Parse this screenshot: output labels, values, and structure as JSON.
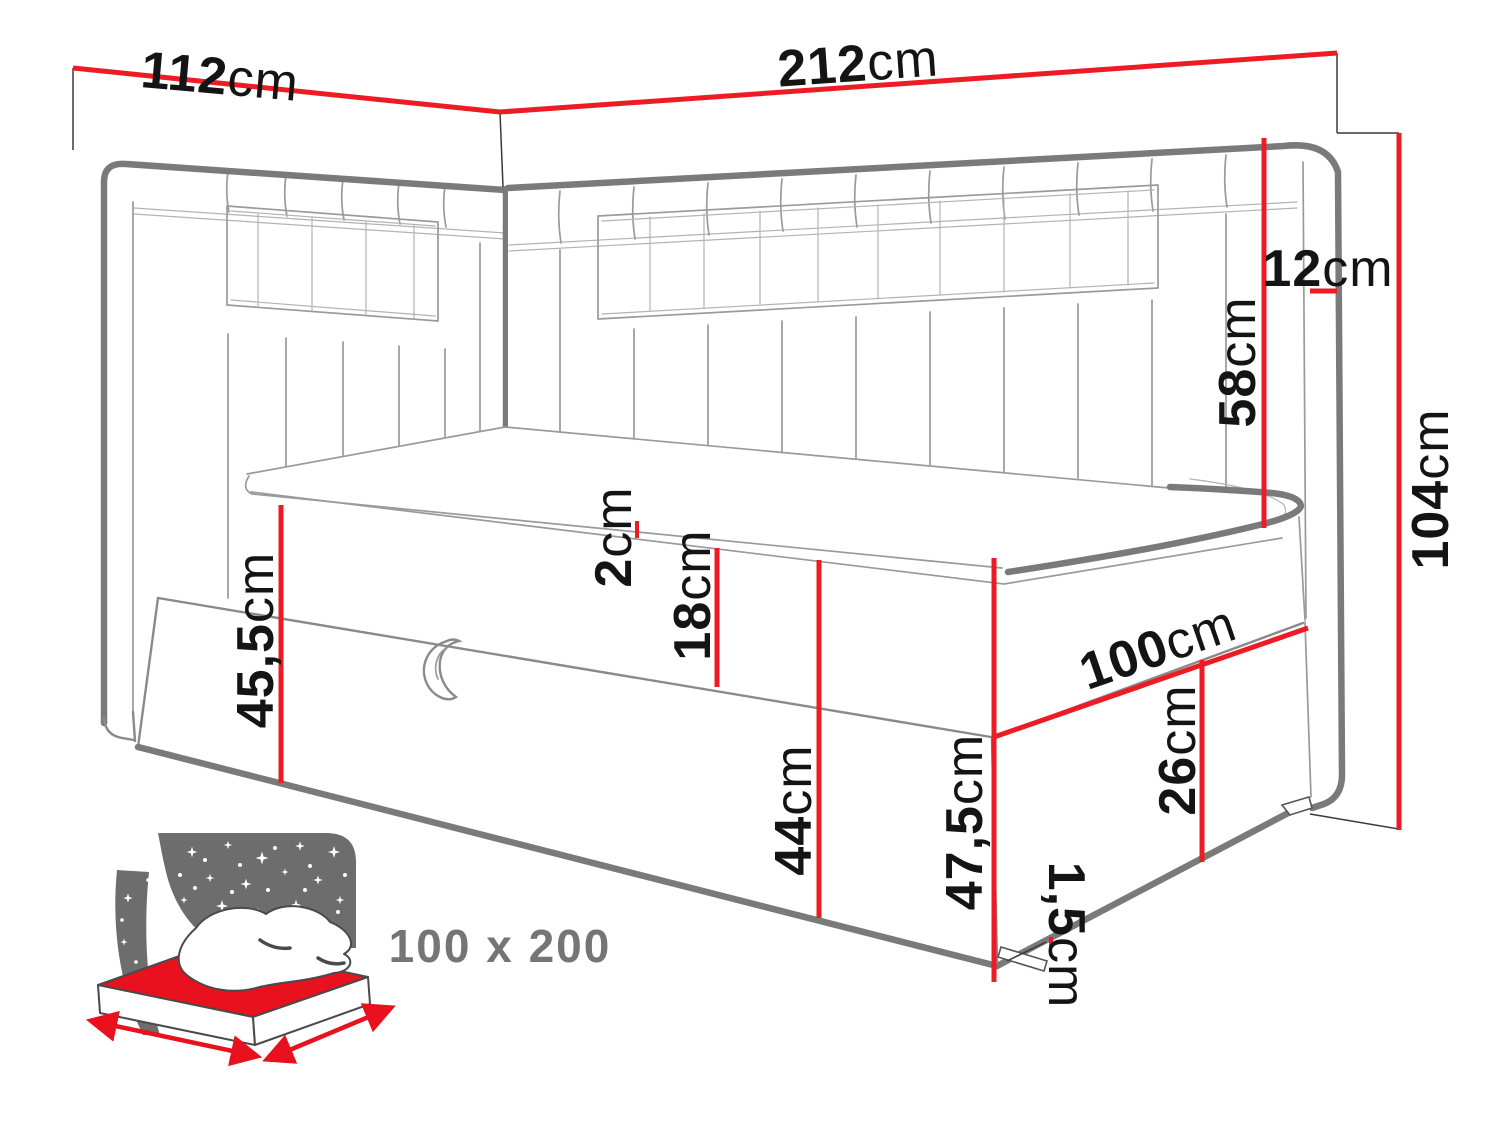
{
  "dims": {
    "w112": {
      "num": "112",
      "unit": "cm"
    },
    "w212": {
      "num": "212",
      "unit": "cm"
    },
    "t12": {
      "num": "12",
      "unit": "cm"
    },
    "h58": {
      "num": "58",
      "unit": "cm"
    },
    "h104": {
      "num": "104",
      "unit": "cm"
    },
    "t2": {
      "num": "2",
      "unit": "cm"
    },
    "h18": {
      "num": "18",
      "unit": "cm"
    },
    "h44": {
      "num": "44",
      "unit": "cm"
    },
    "h455": {
      "num": "45,5",
      "unit": "cm"
    },
    "h475": {
      "num": "47,5",
      "unit": "cm"
    },
    "w100": {
      "num": "100",
      "unit": "cm"
    },
    "h26": {
      "num": "26",
      "unit": "cm"
    },
    "h15": {
      "num": "1,5",
      "unit": "cm"
    }
  },
  "icon": {
    "size_label": "100 x 200"
  },
  "colors": {
    "dimension_red": "#ed1c24",
    "outline_gray": "#7a7a7a",
    "icon_panel_gray": "#6d6d6d",
    "icon_mattress_red": "#e8111d",
    "icon_label_gray": "#757575"
  }
}
